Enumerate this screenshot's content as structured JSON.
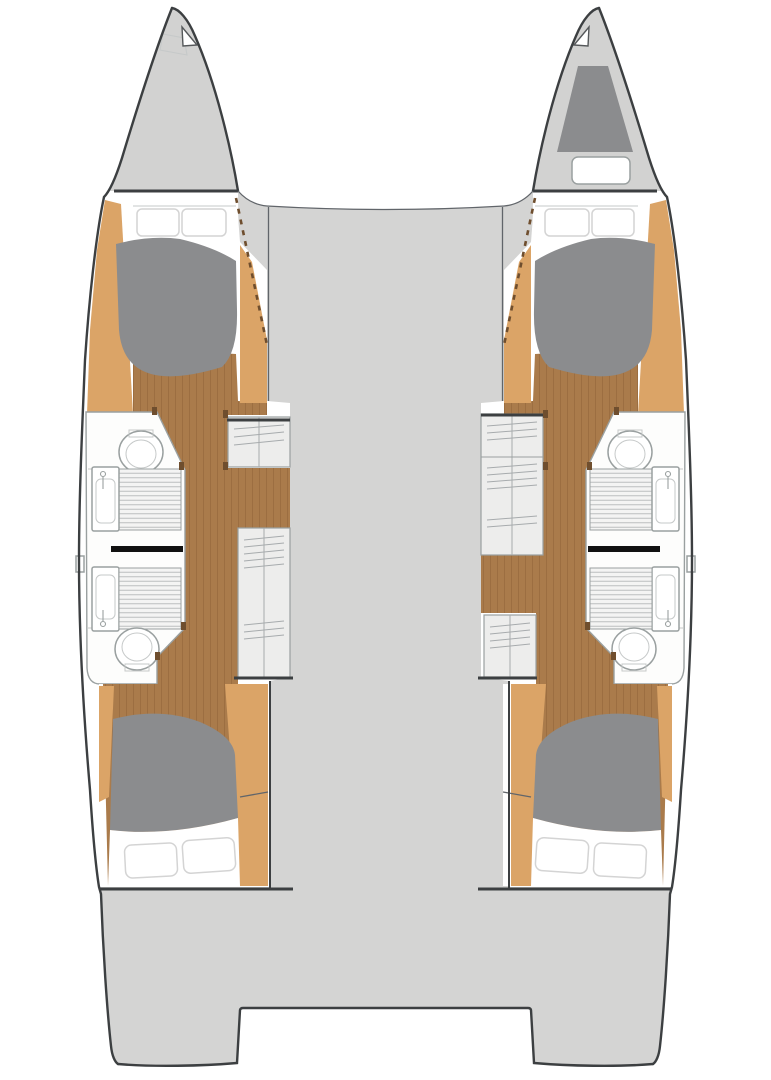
{
  "meta": {
    "title": "Catamaran interior deck plan",
    "description": "Overhead floor plan of a sailing catamaran: two hulls with four double cabins and four bathrooms, companionway steps, wood corridors and a central bridge deck with aft transom cut-out",
    "view": "top-down"
  },
  "colors": {
    "deck": "#d4d4d3",
    "bow": "#d2d2d1",
    "dark": "#8b8c8e",
    "tan": "#dba467",
    "wood": "#aa7b4b",
    "wood_line": "#8f6437",
    "white": "#ffffff",
    "room": "#fdfdfc",
    "step": "#ededec",
    "step_line": "#a7abad",
    "grate": "#f4f4f3",
    "grate_line": "#bcbfbf",
    "outline": "#3c3f41",
    "line": "#61656a",
    "soft_line": "#9aa0a0",
    "lighter_line": "#c6c9c9",
    "door": "#111111",
    "jamb": "#6f4e2e",
    "pillow_line": "#d4d4d4"
  },
  "vessel": {
    "type": "catamaran",
    "configuration": "2 hulls · 4 double cabins · 4 bathrooms",
    "bridge_deck": {
      "name": "bridge deck with aft transom cut-out"
    },
    "bows": [
      {
        "side": "port",
        "features": [
          "anchor locker hatch",
          "bow fitting flag"
        ]
      },
      {
        "side": "starboard",
        "features": [
          "dark storage locker",
          "deck hatch"
        ]
      }
    ],
    "hulls": [
      {
        "side": "port",
        "rooms": [
          {
            "name": "forward cabin",
            "furniture": [
              "double berth",
              "2 pillows",
              "wood floor"
            ]
          },
          {
            "name": "forward bathroom",
            "fixtures": [
              "toilet",
              "shower grate",
              "sink with faucet"
            ]
          },
          {
            "name": "companionway steps",
            "parts": [
              "upper step locker",
              "wood landing",
              "lower stair run"
            ]
          },
          {
            "name": "aft bathroom",
            "fixtures": [
              "sink with faucet",
              "shower grate",
              "toilet"
            ]
          },
          {
            "name": "aft cabin",
            "furniture": [
              "double berth",
              "2 pillows",
              "wood floor"
            ]
          }
        ]
      },
      {
        "side": "starboard",
        "rooms": [
          {
            "name": "forward cabin",
            "furniture": [
              "double berth",
              "2 pillows",
              "wood floor"
            ]
          },
          {
            "name": "forward bathroom",
            "fixtures": [
              "toilet",
              "shower grate",
              "sink with faucet"
            ]
          },
          {
            "name": "companionway steps",
            "parts": [
              "long upper stair run",
              "wood landing",
              "lower step locker"
            ]
          },
          {
            "name": "aft bathroom",
            "fixtures": [
              "sink with faucet",
              "shower grate",
              "toilet"
            ]
          },
          {
            "name": "aft cabin",
            "furniture": [
              "double berth",
              "2 pillows",
              "wood floor"
            ]
          }
        ]
      }
    ],
    "transoms": [
      {
        "side": "port"
      },
      {
        "side": "starboard"
      }
    ]
  }
}
